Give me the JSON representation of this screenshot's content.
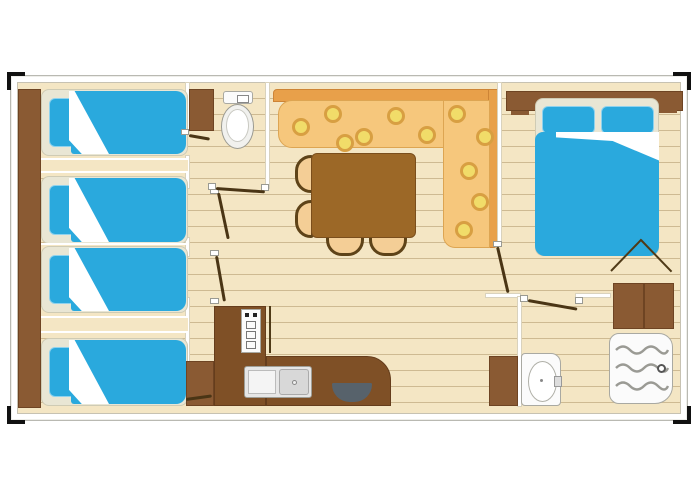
{
  "image_type": "mobile-home-floor-plan",
  "visible_text": [],
  "colors": {
    "page_background": "#ffffff",
    "floor": "#f4e6c4",
    "plank_line": "#af9668",
    "wall": "#ffffff",
    "wood_furniture": "#8a5a33",
    "kitchen_counter": "#7f5026",
    "table": "#9c6827",
    "chair_seat": "#f4ce96",
    "chair_outline": "#5e4318",
    "bed_blue": "#2aa9dd",
    "bed_base": "#e9e6d4",
    "sofa_seat": "#f6c77c",
    "sofa_back": "#e8a04a",
    "sofa_motif": "#f1dc69",
    "sanitary_white": "#fbfbfb",
    "door_leaf": "#4a3515",
    "sink_bowl_dark": "#57626b",
    "corner_mark": "#111111"
  },
  "rooms": [
    {
      "name": "bedroom-1",
      "furniture": [
        "single-bed",
        "pillow",
        "wardrobe-strip",
        "corner-wardrobe",
        "door"
      ]
    },
    {
      "name": "bedroom-2",
      "furniture": [
        "single-bed",
        "single-bed",
        "pillows",
        "wardrobe-strip",
        "doors"
      ]
    },
    {
      "name": "bedroom-3",
      "furniture": [
        "single-bed",
        "pillow",
        "wardrobe-strip",
        "corner-wardrobe",
        "door"
      ]
    },
    {
      "name": "wc",
      "furniture": [
        "toilet",
        "door"
      ]
    },
    {
      "name": "living-dining",
      "furniture": [
        "l-shaped-sofa",
        "dining-table",
        "chair",
        "chair",
        "chair",
        "chair"
      ]
    },
    {
      "name": "master-bedroom",
      "furniture": [
        "double-bed",
        "two-pillows",
        "headboard-shelf",
        "hanging-rail-symbol",
        "door"
      ]
    },
    {
      "name": "bathroom",
      "furniture": [
        "shower-tray",
        "washbasin",
        "cabinet",
        "wardrobe",
        "door"
      ]
    },
    {
      "name": "kitchen",
      "furniture": [
        "l-shaped-counter",
        "stove",
        "sink-with-drainer",
        "round-dark-sink-bowl"
      ]
    }
  ],
  "counts": {
    "single_beds": 4,
    "double_beds": 1,
    "chairs": 4,
    "interior_doors": 7
  }
}
